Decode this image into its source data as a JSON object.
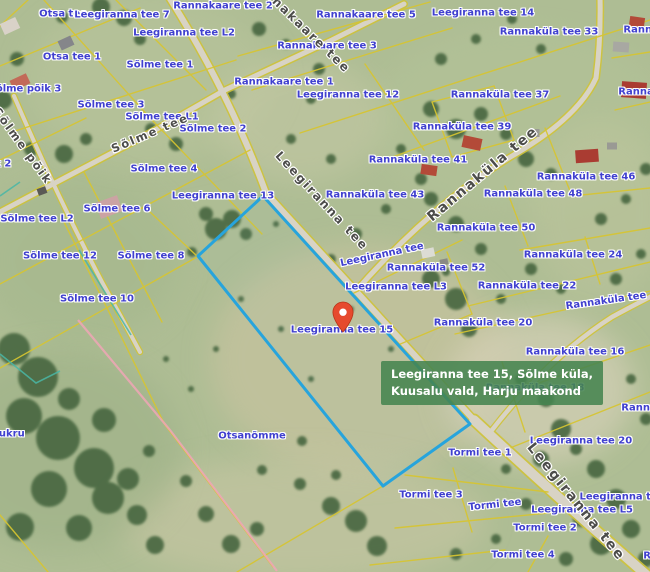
{
  "map": {
    "tooltip": {
      "line1": "Leegiranna tee 15, Sõlme küla,",
      "line2": "Kuusalu vald, Harju maakond"
    },
    "colors": {
      "parcel_line": "#d7c531",
      "highlight_line": "#27a4dc",
      "address_label": "#4040cf",
      "road_label": "#4c4c4a",
      "tooltip_bg": "rgba(70,132,80,0.88)",
      "marker": "#e64a2e",
      "water_line": "#49b7a6",
      "utility_line": "#f0a6b6"
    },
    "parcel_labels": [
      {
        "t": "Otsa tee",
        "x": 63,
        "y": 14
      },
      {
        "t": "Leegiranna tee 7",
        "x": 122,
        "y": 15
      },
      {
        "t": "Rannakaare tee 2",
        "x": 223,
        "y": 6
      },
      {
        "t": "Rannakaare tee 5",
        "x": 366,
        "y": 15
      },
      {
        "t": "Leegiranna tee 14",
        "x": 483,
        "y": 13
      },
      {
        "t": "Rannaküla tee 33",
        "x": 549,
        "y": 32
      },
      {
        "t": "Rannakü",
        "x": 648,
        "y": 30
      },
      {
        "t": "Leegiranna tee L2",
        "x": 184,
        "y": 33
      },
      {
        "t": "Rannakaare tee 3",
        "x": 327,
        "y": 46
      },
      {
        "t": "Otsa tee 1",
        "x": 72,
        "y": 57
      },
      {
        "t": "Sõlme tee 1",
        "x": 160,
        "y": 65
      },
      {
        "t": "Rannaküla tee 37",
        "x": 500,
        "y": 95
      },
      {
        "t": "Sõlme põik 3",
        "x": 25,
        "y": 89
      },
      {
        "t": "Rannakaare tee 1",
        "x": 284,
        "y": 82
      },
      {
        "t": "Rannaküla",
        "x": 648,
        "y": 92
      },
      {
        "t": "Leegiranna tee 12",
        "x": 348,
        "y": 95
      },
      {
        "t": "Sõlme tee 3",
        "x": 111,
        "y": 105
      },
      {
        "t": "Sõlme tee L1",
        "x": 162,
        "y": 117
      },
      {
        "t": "Sõlme tee 2",
        "x": 213,
        "y": 129
      },
      {
        "t": "Rannaküla tee 39",
        "x": 462,
        "y": 127
      },
      {
        "t": "Rannaküla tee 41",
        "x": 418,
        "y": 160
      },
      {
        "t": "Sõlme tee 4",
        "x": 164,
        "y": 169
      },
      {
        "t": "Rannaküla tee 46",
        "x": 586,
        "y": 177
      },
      {
        "t": "Rannaküla tee 43",
        "x": 375,
        "y": 195
      },
      {
        "t": "Rannaküla tee 48",
        "x": 533,
        "y": 194
      },
      {
        "t": "Leegiranna tee 13",
        "x": 223,
        "y": 196
      },
      {
        "t": "Sõlme tee 6",
        "x": 117,
        "y": 209
      },
      {
        "t": "Sõlme tee L2",
        "x": 37,
        "y": 219
      },
      {
        "t": "Rannaküla tee 50",
        "x": 486,
        "y": 228
      },
      {
        "t": "põik 2",
        "x": -6,
        "y": 164
      },
      {
        "t": "Rannaküla tee 52",
        "x": 436,
        "y": 268
      },
      {
        "t": "Rannaküla tee 24",
        "x": 573,
        "y": 255
      },
      {
        "t": "Sõlme tee 12",
        "x": 60,
        "y": 256
      },
      {
        "t": "Sõlme tee 8",
        "x": 151,
        "y": 256
      },
      {
        "t": "Leegiranna tee",
        "x": 382,
        "y": 255,
        "r": -12
      },
      {
        "t": "Rannaküla tee 22",
        "x": 527,
        "y": 286
      },
      {
        "t": "Leegiranna tee L3",
        "x": 396,
        "y": 287
      },
      {
        "t": "Sõlme tee 10",
        "x": 97,
        "y": 299
      },
      {
        "t": "Rannaküla tee",
        "x": 606,
        "y": 301,
        "r": -8
      },
      {
        "t": "Rannaküla tee 20",
        "x": 483,
        "y": 323
      },
      {
        "t": "Leegiranna tee 15",
        "x": 342,
        "y": 330
      },
      {
        "t": "Rannaküla tee 16",
        "x": 575,
        "y": 352
      },
      {
        "t": "Rannaküla tee 18",
        "x": 535,
        "y": 388
      },
      {
        "t": "Rannaküla",
        "x": 651,
        "y": 408
      },
      {
        "t": "Kukru",
        "x": 8,
        "y": 434
      },
      {
        "t": "Otsanõmme",
        "x": 252,
        "y": 436
      },
      {
        "t": "Leegiranna tee 20",
        "x": 581,
        "y": 441
      },
      {
        "t": "Tormi tee 1",
        "x": 480,
        "y": 453
      },
      {
        "t": "Tormi tee 3",
        "x": 431,
        "y": 495
      },
      {
        "t": "Leegiranna tee",
        "x": 622,
        "y": 497
      },
      {
        "t": "Tormi tee",
        "x": 495,
        "y": 505,
        "r": -6
      },
      {
        "t": "Leegiranna tee L5",
        "x": 582,
        "y": 510
      },
      {
        "t": "Tormi tee 2",
        "x": 545,
        "y": 528
      },
      {
        "t": "Tormi tee 4",
        "x": 523,
        "y": 555
      },
      {
        "t": "Ran",
        "x": 654,
        "y": 556
      }
    ],
    "road_labels": [
      {
        "t": "Rannakaare tee",
        "x": 300,
        "y": 24,
        "r": 44,
        "s": 12
      },
      {
        "t": "Sõlme tee",
        "x": 150,
        "y": 133,
        "r": -23,
        "s": 11.5
      },
      {
        "t": "Sõlme põik",
        "x": 23,
        "y": 146,
        "r": 54,
        "s": 11.5
      },
      {
        "t": "Leegiranna tee",
        "x": 322,
        "y": 201,
        "r": 47,
        "s": 12
      },
      {
        "t": "Rannaküla tee",
        "x": 483,
        "y": 174,
        "r": -40,
        "s": 14
      },
      {
        "t": "Leegiranna tee",
        "x": 576,
        "y": 502,
        "r": 51,
        "s": 14
      }
    ]
  }
}
